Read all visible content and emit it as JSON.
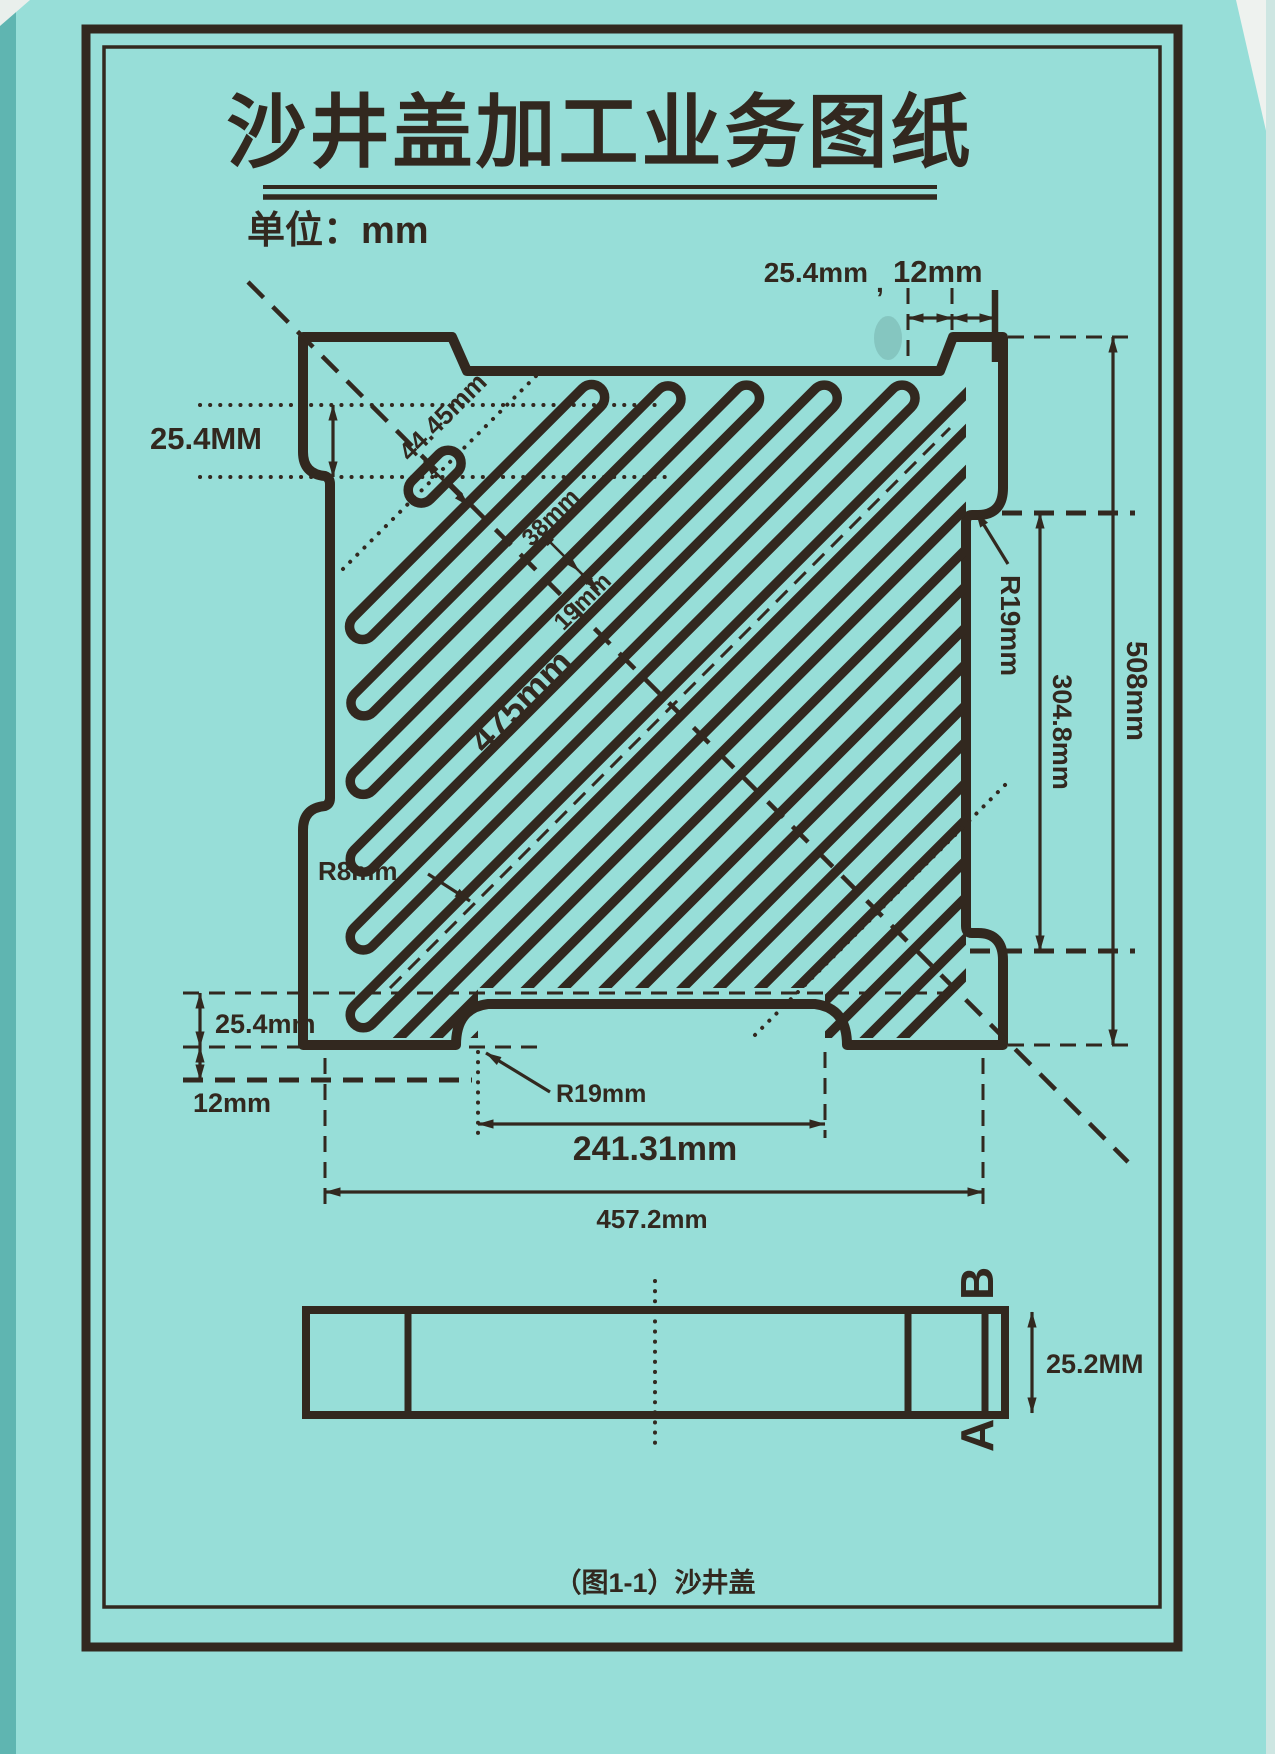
{
  "page": {
    "title": "沙井盖加工业务图纸",
    "unit_label": "单位：mm",
    "caption": "（图1-1）沙井盖",
    "paper_color": "#97ded8",
    "ink_color": "#32281f"
  },
  "plan": {
    "dims": {
      "top_offset": "25.4mm",
      "separator": ",",
      "top_edge": "12mm",
      "top_left_depth": "25.4MM",
      "corner_slot": "44.45mm",
      "slot_pitch": "38mm",
      "slot_width": "19mm",
      "center_slot_length": "475mm",
      "side_radius": "R19mm",
      "side_recess_height": "304.8mm",
      "overall_height": "508mm",
      "slot_end_radius": "R8mm",
      "bottom_left_depth": "25.4mm",
      "bottom_left_edge": "12mm",
      "notch_radius": "R19mm",
      "notch_width": "241.31mm",
      "overall_width": "457.2mm"
    }
  },
  "section": {
    "label_top": "B",
    "label_bottom": "A",
    "thickness": "25.2MM"
  }
}
